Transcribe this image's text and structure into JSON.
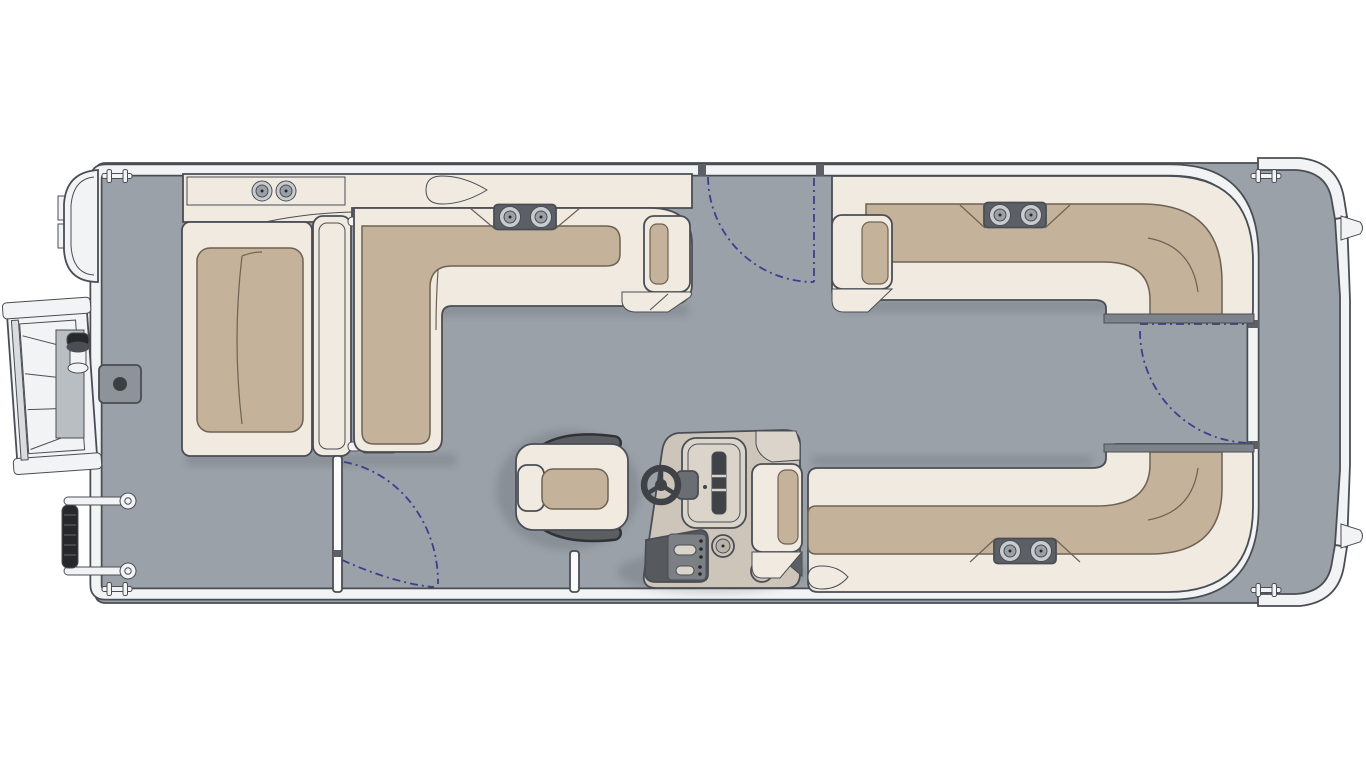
{
  "meta": {
    "title": "Pontoon boat floor plan — top view",
    "view": "top-down deck plan, bow at left, stern at right"
  },
  "colors": {
    "bg": "#ffffff",
    "deck": "#9ba1a8",
    "trim": "#f2f3f4",
    "trimMid": "#d9dcdf",
    "outline": "#4a4e54",
    "cream": "#f0eae1",
    "tan": "#c4b29a",
    "tanEdge": "#6e6353",
    "hardware": "#5c6066",
    "panel": "#565a5f",
    "gauge": "#3f4347",
    "console": "#cdc5ba",
    "consoleLight": "#dad4ca",
    "metal": "#c9ccce",
    "metalDeep": "#9aa0a5",
    "navy": "#3d3f8e",
    "shadow": "#2f343a",
    "black": "#26282a",
    "endStrip": "#7d838a",
    "plate": "#8d9399"
  },
  "boat": {
    "zones": {
      "bow": [
        "boarding-gate-with-ladder",
        "tow-knob",
        "gate-hardware",
        "table-base-plate",
        "bow-cleats"
      ],
      "midship_port": [
        "bow-chaise-lounge",
        "adjustable-backrest-divider",
        "l-shaped-lounge",
        "armrest",
        "side-gate"
      ],
      "helm": [
        "captain-chair",
        "helm-console",
        "steering-wheel",
        "gauge-cluster",
        "switch-panel"
      ],
      "stern": [
        "port-rear-l-bench",
        "starboard-rear-l-bench",
        "stern-gate",
        "stern-platform",
        "stern-cleats"
      ]
    },
    "gates": [
      {
        "name": "top-side-gate",
        "state": "closed",
        "swing": "inward"
      },
      {
        "name": "port-side-gate",
        "state": "open",
        "swing": "inward"
      },
      {
        "name": "stern-gate",
        "state": "closed",
        "swing": "inward"
      },
      {
        "name": "bow-gate",
        "state": "open-with-ladder",
        "swing": "outward"
      }
    ],
    "cupholders": {
      "bow_console": 2,
      "port_bench_backrest": 2,
      "rear_top_bench_backrest": 2,
      "rear_bottom_bench_backrest": 2,
      "helm_console": 2
    },
    "cleats": 4
  }
}
